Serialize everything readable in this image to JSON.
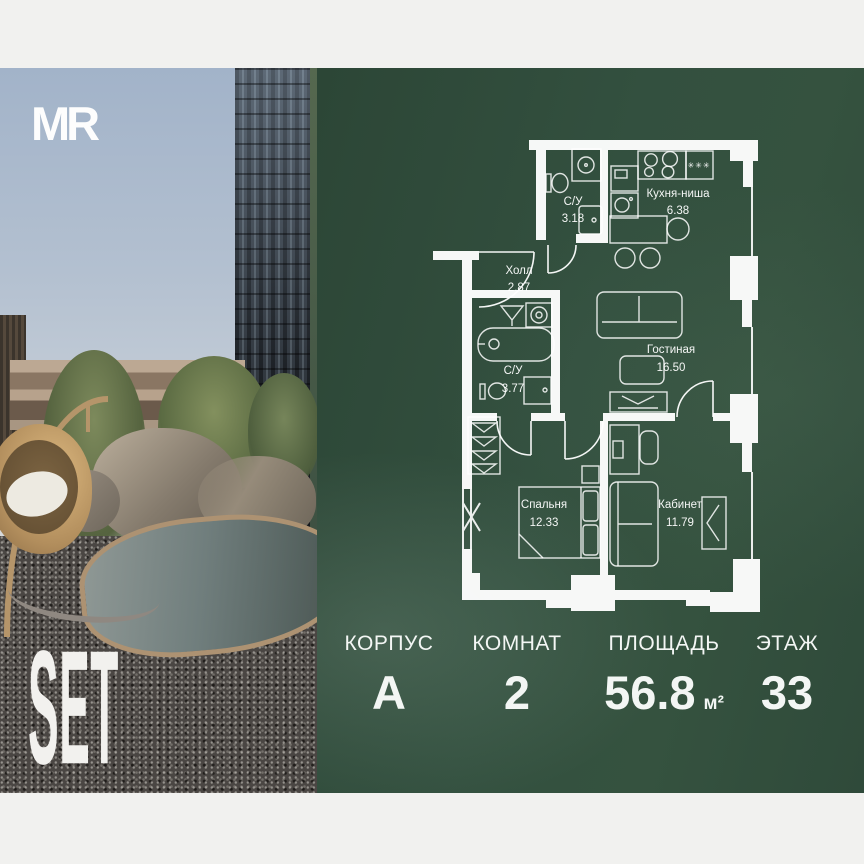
{
  "brand": {
    "logo_text": "MR",
    "project_name": "SET"
  },
  "floor_plan": {
    "rooms": [
      {
        "name": "С/У",
        "area": "3.18"
      },
      {
        "name": "Кухня-ниша",
        "area": "6.38"
      },
      {
        "name": "Холл",
        "area": "2.87"
      },
      {
        "name": "Гостиная",
        "area": "16.50"
      },
      {
        "name": "С/У",
        "area": "3.77"
      },
      {
        "name": "Спальня",
        "area": "12.33"
      },
      {
        "name": "Кабинет",
        "area": "11.79"
      }
    ],
    "fridge_symbol": "✳✳✳"
  },
  "summary": {
    "columns": [
      {
        "label": "КОРПУС",
        "value": "А"
      },
      {
        "label": "КОМНАТ",
        "value": "2"
      },
      {
        "label": "ПЛОЩАДЬ",
        "value": "56.8",
        "unit": "м²"
      },
      {
        "label": "ЭТАЖ",
        "value": "33"
      }
    ]
  },
  "colors": {
    "panel_green": "#33503f",
    "frame_bar": "#f1f1ef",
    "plan_lines": "#ffffff"
  }
}
